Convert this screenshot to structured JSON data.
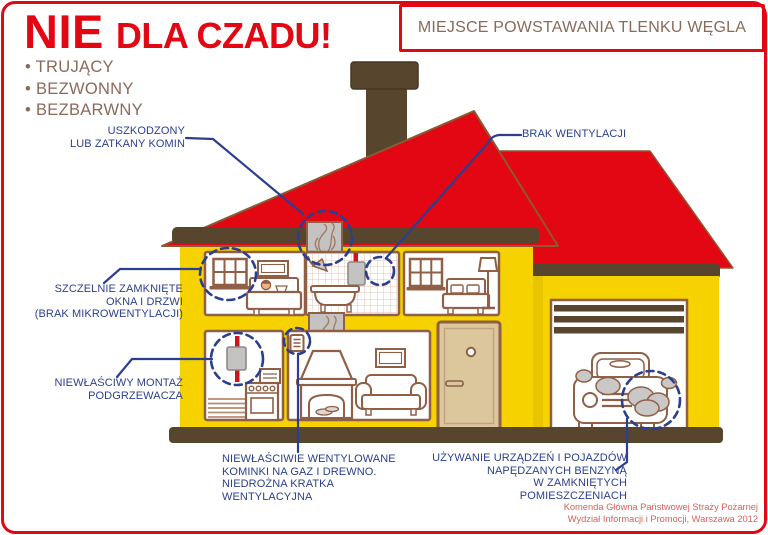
{
  "poster": {
    "title": {
      "main": "NIE",
      "rest": "DLA CZADU!"
    },
    "bullets": [
      "• TRUJĄCY",
      "• BEZWONNY",
      "• BEZBARWNY"
    ],
    "header_box": {
      "label": "MIEJSCE POWSTAWANIA TLENKU WĘGLA"
    },
    "callouts": {
      "chimney": "USZKODZONY\nLUB ZATKANY KOMIN",
      "ventilation": "BRAK WENTYLACJI",
      "windows": "SZCZELNIE ZAMKNIĘTE\nOKNA I DRZWI\n(BRAK MIKROWENTYLACJI)",
      "heater": "NIEWŁAŚCIWY MONTAŻ\nPODGRZEWACZA",
      "fireplace": "NIEWŁAŚCIWIE WENTYLOWANE\nKOMINKI NA GAZ I DREWNO.\nNIEDROŻNA KRATKA\nWENTYLACYJNA",
      "garage": "UŻYWANIE URZĄDZEŃ I POJAZDÓW\nNAPĘDZANYCH BENZYNĄ\nW ZAMKNIĘTYCH POMIESZCZENIACH"
    },
    "credits": {
      "line1": "Komenda Główna Państwowej Straży Pożarnej",
      "line2": "Wydział Informacji i Promocji, Warszawa 2012"
    },
    "colors": {
      "accent_red": "#e30613",
      "roof_red": "#e30613",
      "wall_yellow": "#f5d200",
      "trim_dark_brown": "#57452e",
      "outline_brown": "#8f5f46",
      "label_blue": "#2b3f90",
      "text_brown": "#8a6a5a",
      "credit_salmon": "#d96156",
      "smoke_gray": "#c4c3c1",
      "pipe_red": "#d41414",
      "door_tan": "#dcc69c"
    }
  }
}
